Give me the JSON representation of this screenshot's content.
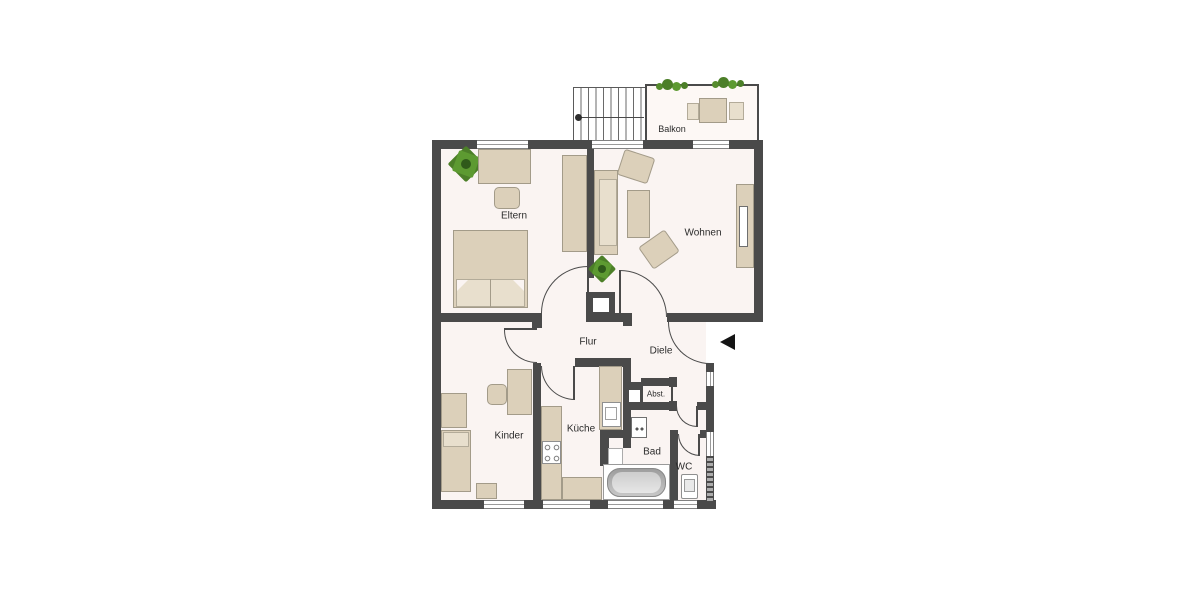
{
  "plan_type": "apartment-floor-plan",
  "colors": {
    "wall": "#4a4a4a",
    "floor": "#faf4f2",
    "balcony_floor": "#fdf8f5",
    "furniture": "#dcd0ba",
    "furniture_light": "#e8dfcd",
    "plant_green": "#5d9a31",
    "entrance_arrow": "#141414"
  },
  "rooms": {
    "eltern": {
      "label": "Eltern",
      "furniture": [
        "double-bed",
        "desk",
        "chair",
        "wardrobe",
        "plant"
      ]
    },
    "wohnen": {
      "label": "Wohnen",
      "furniture": [
        "sofa",
        "coffee-table",
        "armchair",
        "armchair",
        "sideboard-tv",
        "plant"
      ]
    },
    "balkon": {
      "label": "Balkon",
      "furniture": [
        "table",
        "chair",
        "chair",
        "planter",
        "planter"
      ]
    },
    "flur": {
      "label": "Flur"
    },
    "diele": {
      "label": "Diele"
    },
    "kinder": {
      "label": "Kinder",
      "furniture": [
        "bed",
        "wardrobe",
        "nightstand",
        "desk",
        "chair"
      ]
    },
    "kueche": {
      "label": "Küche",
      "furniture": [
        "counter-l-shape",
        "stove",
        "sink",
        "counter-with-sink"
      ]
    },
    "bad": {
      "label": "Bad",
      "furniture": [
        "bathtub",
        "washing-machine",
        "shower-niche"
      ]
    },
    "wc": {
      "label": "WC",
      "furniture": [
        "toilet"
      ]
    },
    "abst": {
      "label": "Abst."
    }
  },
  "features": {
    "staircase": "exterior stairs top of plan",
    "entrance": "arrow pointing left at right side of Diele",
    "chimney_shafts": 2,
    "windows_top": 3,
    "windows_bottom": 4,
    "windows_right": 2
  }
}
